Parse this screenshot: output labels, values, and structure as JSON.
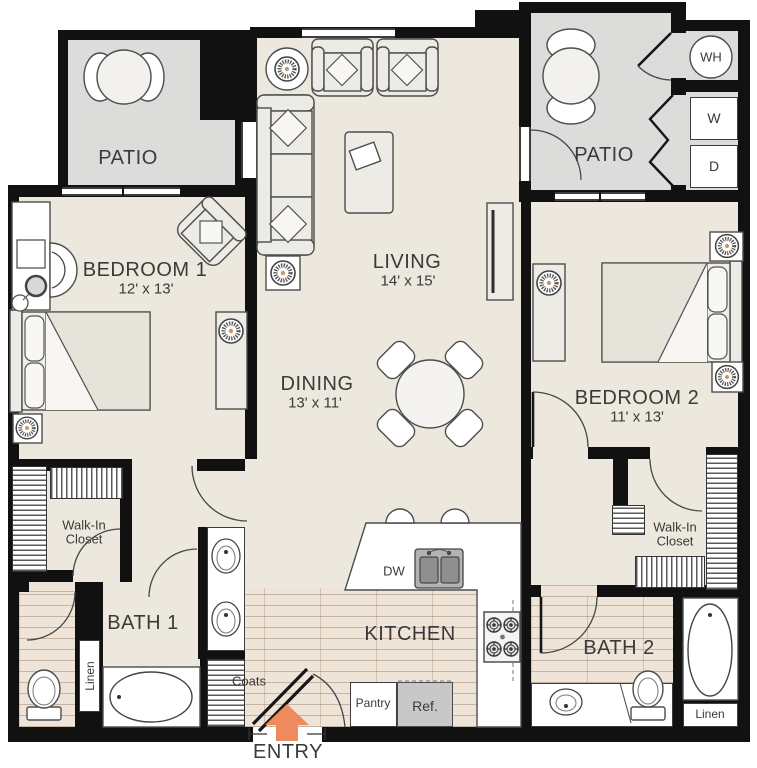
{
  "labels": {
    "patio": "PATIO",
    "living": "LIVING",
    "living_dims": "14' x 15'",
    "dining": "DINING",
    "dining_dims": "13' x 11'",
    "bedroom1": "BEDROOM 1",
    "bedroom1_dims": "12' x 13'",
    "bedroom2": "BEDROOM 2",
    "bedroom2_dims": "11' x 13'",
    "kitchen": "KITCHEN",
    "bath1": "BATH 1",
    "bath2": "BATH 2",
    "walkin_line1": "Walk-In",
    "walkin_line2": "Closet",
    "linen": "Linen",
    "coats": "Coats",
    "pantry": "Pantry",
    "entry": "ENTRY",
    "wh": "WH",
    "washer": "W",
    "dryer": "D",
    "dw": "DW",
    "ref": "Ref."
  },
  "colors": {
    "wall": "#111111",
    "floor_main": "#ece8dd",
    "floor_patio": "#dcdcdb",
    "floor_wood": "#efe4d8",
    "accent": "#ed8a5e",
    "outline": "#4d4d4d",
    "text": "#3a3a3a"
  }
}
